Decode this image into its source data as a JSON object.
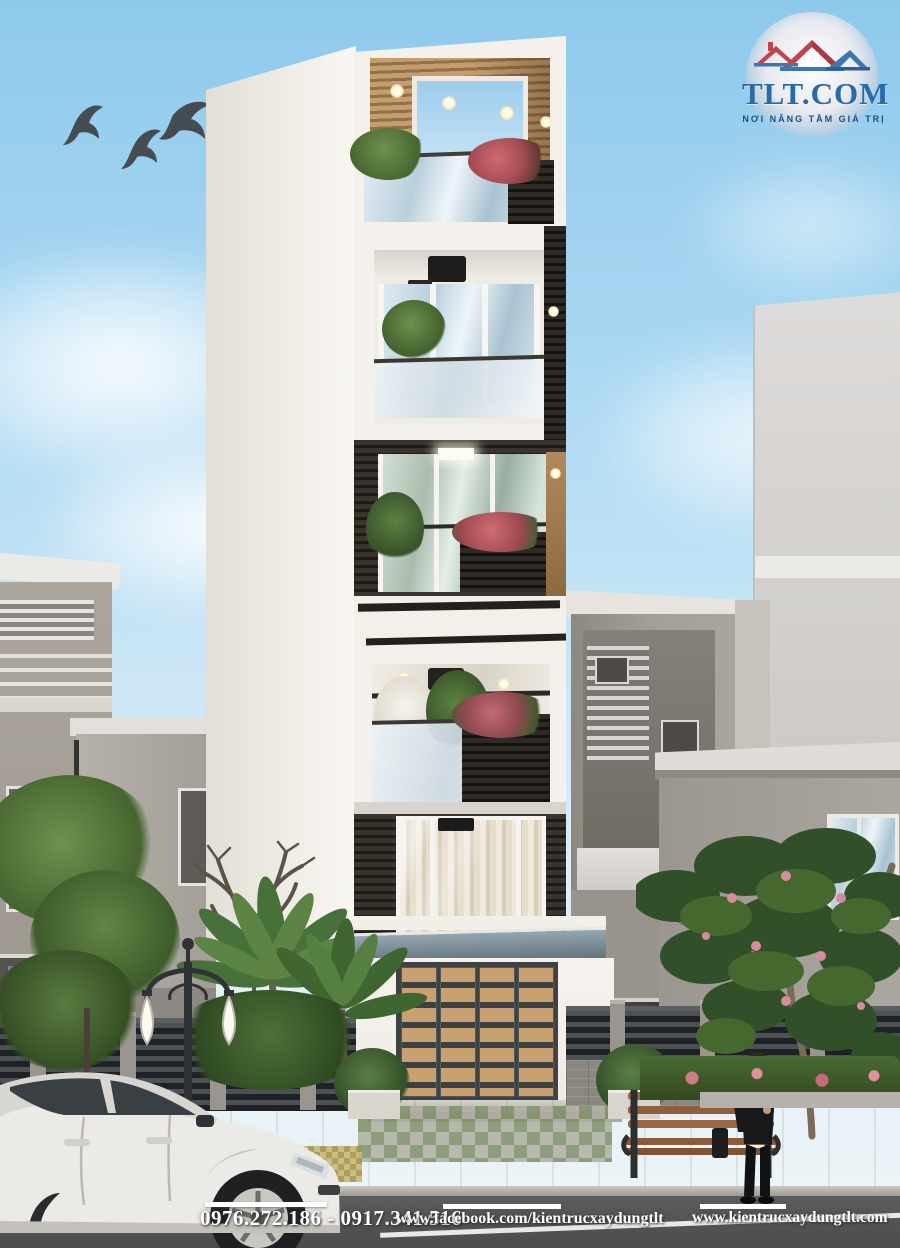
{
  "branding": {
    "logo_title": "TLT.COM",
    "logo_slogan": "NƠI NÂNG TẦM GIÁ TRỊ"
  },
  "footer": {
    "phone": "0976.272.186 - 0917.341.516",
    "facebook_url": "www.facebook.com/kientrucxaydungtlt",
    "website_url": "www.kientrucxaydungtlt.com"
  },
  "colors": {
    "sky_top": "#8ec9ec",
    "sky_bottom": "#eef5f7",
    "logo_blue": "#2a6aa6",
    "logo_slogan_blue": "#1c4f86",
    "roof_red": "#c0444a",
    "roof_blue": "#3d77b0",
    "door_wood": "#c89f6e",
    "dark_cladding": "#2b2825",
    "foliage_green": "#4e6b3a",
    "flower_pink": "#d88aa0",
    "road_gray": "#4a4c4e",
    "footer_text": "#ffffff"
  }
}
